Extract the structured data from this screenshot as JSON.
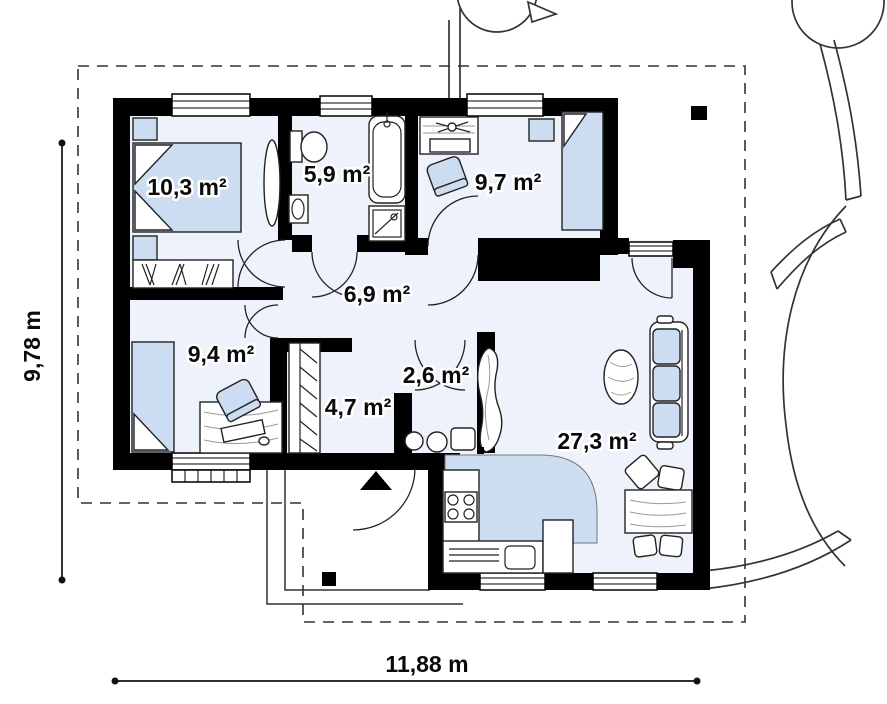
{
  "plan": {
    "rooms": [
      {
        "id": "bedroom-1",
        "area": "10,3 m²"
      },
      {
        "id": "bathroom",
        "area": "5,9 m²"
      },
      {
        "id": "bedroom-2",
        "area": "9,7 m²"
      },
      {
        "id": "hall",
        "area": "6,9 m²"
      },
      {
        "id": "bedroom-3",
        "area": "9,4 m²"
      },
      {
        "id": "wardrobe-vestibule",
        "area": "4,7 m²"
      },
      {
        "id": "wc",
        "area": "2,6 m²"
      },
      {
        "id": "living-room-kitchen",
        "area": "27,3 m²"
      }
    ],
    "dimensions": {
      "width": "11,88 m",
      "height": "9,78 m"
    },
    "colors": {
      "wall": "#000000",
      "furniture_accent": "#ccdcf1",
      "floor": "#eef2fa",
      "line": "#333333"
    }
  }
}
